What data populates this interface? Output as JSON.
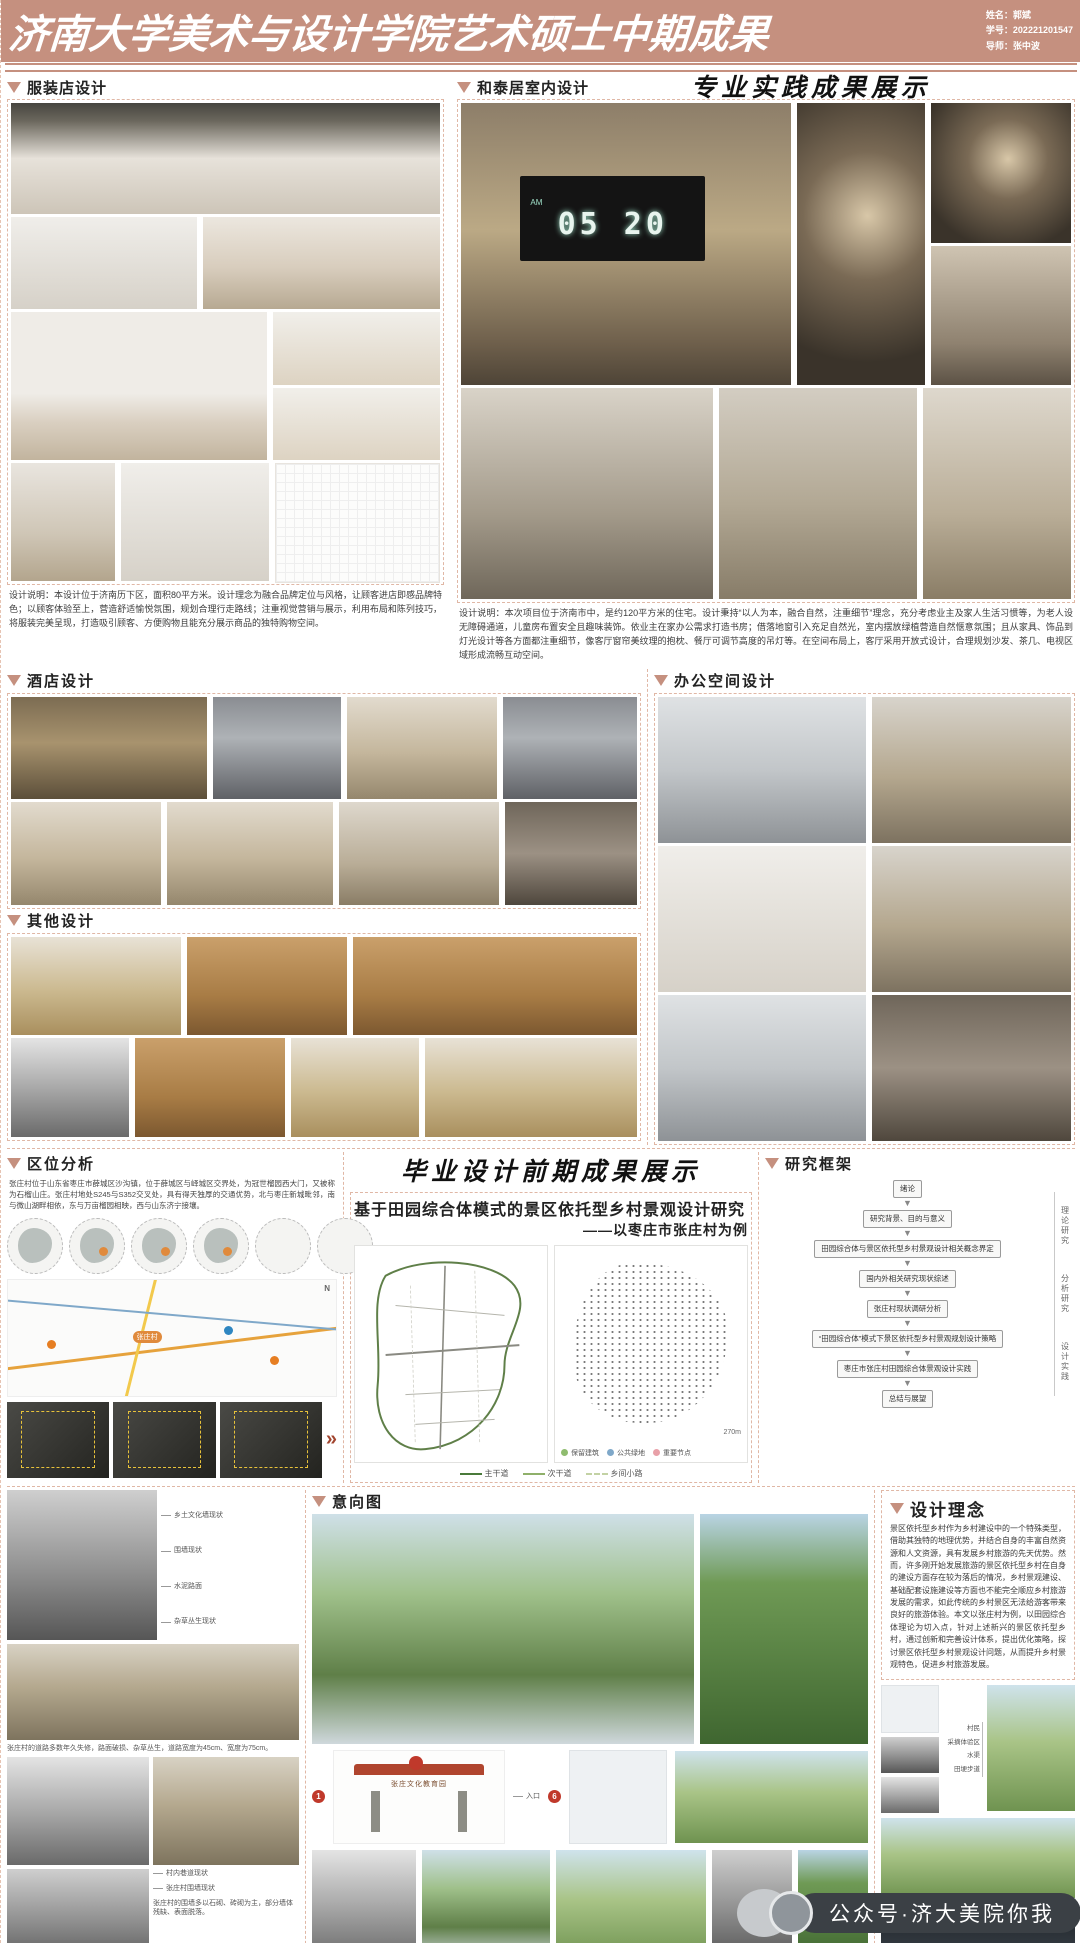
{
  "header": {
    "title": "济南大学美术与设计学院艺术硕士中期成果",
    "name_label": "姓名：",
    "name": "郭斌",
    "sid_label": "学号：",
    "sid": "202221201547",
    "advisor_label": "导师：",
    "advisor": "张中波"
  },
  "subtitles": {
    "practice": "专业实践成果展示",
    "graduation": "毕业设计前期成果展示"
  },
  "clothing": {
    "title": "服装店设计",
    "desc": "设计说明：本设计位于济南历下区，面积80平方米。设计理念为融合品牌定位与风格，让顾客进店即感品牌特色；以顾客体验至上，营造舒适愉悦氛围，规划合理行走路线；注重视觉营销与展示，利用布局和陈列技巧，将服装完美呈现，打造吸引顾客、方便购物且能充分展示商品的独特购物空间。"
  },
  "hetai": {
    "title": "和泰居室内设计",
    "clock_am": "AM",
    "clock_time": "05 20",
    "desc": "设计说明：本次项目位于济南市中，是约120平方米的住宅。设计秉持“以人为本，融合自然，注重细节”理念，充分考虑业主及家人生活习惯等，为老人设无障碍通道，儿童房布置安全且趣味装饰。依业主在家办公需求打造书房；借落地窗引入充足自然光，室内摆放绿植营造自然惬意氛围；且从家具、饰品到灯光设计等各方面都注重细节，像客厅窗帘美纹理的抱枕、餐厅可调节高度的吊灯等。在空间布局上，客厅采用开放式设计，合理规划沙发、茶几、电视区域形成流畅互动空间。"
  },
  "hotel": {
    "title": "酒店设计"
  },
  "office": {
    "title": "办公空间设计"
  },
  "other": {
    "title": "其他设计"
  },
  "location": {
    "title": "区位分析",
    "desc": "张庄村位于山东省枣庄市薛城区沙沟镇，位于薛城区与峄城区交界处，为冠世榴园西大门，又被称为石榴山庄。张庄村地处S245与S352交叉处，具有得天独厚的交通优势，北与枣庄新城毗邻，南与微山湖畔相依，东与万亩榴园相映，西与山东济宁接壤。",
    "village_pill": "张庄村",
    "compass": "N",
    "arrow": "»"
  },
  "thesis": {
    "title": "基于田园综合体模式的景区依托型乡村景观设计研究",
    "subtitle": "——以枣庄市张庄村为例",
    "road_legend": [
      {
        "label": "主干道"
      },
      {
        "label": "次干道"
      },
      {
        "label": "乡间小路"
      }
    ],
    "site_legend": [
      {
        "label": "保留建筑"
      },
      {
        "label": "公共绿地"
      },
      {
        "label": "重要节点"
      }
    ],
    "scale": "270m"
  },
  "framework": {
    "title": "研究框架",
    "boxes": [
      "绪论",
      "研究背景、目的与意义",
      "田园综合体与景区依托型乡村景观设计相关概念界定",
      "国内外相关研究现状综述",
      "张庄村现状调研分析",
      "“田园综合体”模式下景区依托型乡村景观规划设计策略",
      "枣庄市张庄村田园综合体景观设计实践",
      "总结与展望"
    ],
    "stages": [
      "理论研究",
      "分析研究",
      "设计实践"
    ]
  },
  "village": {
    "captions": [
      "乡土文化墙现状",
      "围墙现状",
      "水泥路面",
      "杂草丛生现状",
      "村内巷道现状",
      "张庄村围墙现状"
    ],
    "note1": "张庄村的道路多数年久失修，路面破损、杂草丛生，道路宽度为45cm、宽度为75cm。",
    "note2": "张庄村的围墙多以石砌、砖砌为主，部分墙体残缺、表面脱落。"
  },
  "intention": {
    "title": "意向图",
    "gate_text": "张庄文化教育园",
    "entry_label": "入口",
    "field_labels": [
      "村民",
      "采摘体验区",
      "水渠",
      "田埂步道"
    ],
    "badges": [
      "1",
      "6"
    ]
  },
  "concept": {
    "title": "设计理念",
    "desc": "景区依托型乡村作为乡村建设中的一个特殊类型，借助其独特的地理优势，并结合自身的丰富自然资源和人文资源，具有发展乡村旅游的先天优势。然而，许多刚开始发展旅游的景区依托型乡村在自身的建设方面存在较为落后的情况，乡村景观建设、基础配套设施建设等方面也不能完全顺应乡村旅游发展的需求，如此传统的乡村景区无法给游客带来良好的旅游体验。本文以张庄村为例，以田园综合体理论为切入点，针对上述新兴的景区依托型乡村，通过创新和完善设计体系，提出优化策略，探讨景区依托型乡村景观设计问题，从而提升乡村景观特色，促进乡村旅游发展。",
    "caption_night": "露天电影场景"
  },
  "watermark": {
    "text": "公众号·济大美院你我"
  }
}
